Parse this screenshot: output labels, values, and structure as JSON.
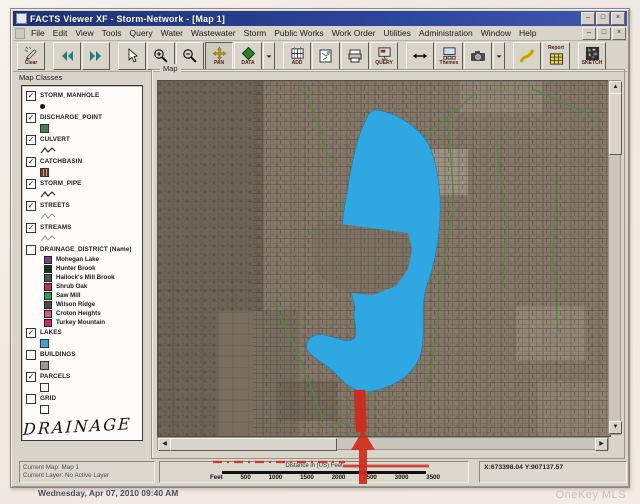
{
  "window": {
    "title": "FACTS Viewer XF - Storm-Network - [Map 1]",
    "controls": [
      "–",
      "□",
      "×"
    ],
    "menu_items": [
      "File",
      "Edit",
      "View",
      "Tools",
      "Query",
      "Water",
      "Wastewater",
      "Storm",
      "Public Works",
      "Work Order",
      "Utilities",
      "Administration",
      "Window",
      "Help"
    ]
  },
  "toolbar": {
    "groups": [
      [
        {
          "name": "clear-button",
          "icon": "pencil",
          "label": "Clear"
        }
      ],
      [
        {
          "name": "previous-view-button",
          "icon": "arrows-left",
          "label": ""
        },
        {
          "name": "next-view-button",
          "icon": "arrows-right",
          "label": ""
        }
      ],
      [
        {
          "name": "pointer-button",
          "icon": "pointer",
          "label": ""
        },
        {
          "name": "zoom-in-button",
          "icon": "zoom-in",
          "label": ""
        },
        {
          "name": "zoom-out-button",
          "icon": "zoom-out",
          "label": ""
        },
        {
          "name": "pan-button",
          "icon": "pan",
          "label": "PAN",
          "pressed": true
        },
        {
          "name": "data-button",
          "icon": "data",
          "label": "DATA"
        },
        {
          "name": "data-dropdown",
          "icon": "caret",
          "label": "",
          "sliver": true
        }
      ],
      [
        {
          "name": "add-button",
          "icon": "grid",
          "label": "ADD"
        },
        {
          "name": "map-sheet-button",
          "icon": "map-sheet",
          "label": ""
        },
        {
          "name": "print-button",
          "icon": "printer",
          "label": ""
        },
        {
          "name": "query-button",
          "icon": "query",
          "label": "QUERY"
        }
      ],
      [
        {
          "name": "measure-button",
          "icon": "measure",
          "label": ""
        },
        {
          "name": "themes-button",
          "icon": "themes",
          "label": "Themes"
        },
        {
          "name": "camera-button",
          "icon": "camera",
          "label": ""
        },
        {
          "name": "camera-dropdown",
          "icon": "caret",
          "label": "",
          "sliver": true
        }
      ],
      [
        {
          "name": "report-flow-button",
          "icon": "swoosh",
          "label": ""
        },
        {
          "name": "report-button",
          "icon": "report-table",
          "label": "Report",
          "label_top": true
        }
      ],
      [
        {
          "name": "sketch-button",
          "icon": "sketch",
          "label": "SKETCH"
        }
      ]
    ]
  },
  "map_classes": {
    "title": "Map Classes",
    "items": [
      {
        "label": "STORM_MANHOLE",
        "checked": true,
        "symbol": "dot"
      },
      {
        "label": "DISCHARGE_POINT",
        "checked": true,
        "symbol": "green-square"
      },
      {
        "label": "CULVERT",
        "checked": true,
        "symbol": "zigzag"
      },
      {
        "label": "CATCHBASIN",
        "checked": true,
        "symbol": "striped-square"
      },
      {
        "label": "STORM_PIPE",
        "checked": true,
        "symbol": "zigzag"
      },
      {
        "label": "STREETS",
        "checked": true,
        "symbol": "zigzag-light"
      },
      {
        "label": "STREAMS",
        "checked": true,
        "symbol": "zigzag-light"
      },
      {
        "label": "DRAINAGE_DISTRICT (Name)",
        "checked": false,
        "symbol": "none",
        "children": [
          {
            "label": "Mohegan Lake",
            "color": "#7c3f7e"
          },
          {
            "label": "Hunter Brook",
            "color": "#20301f"
          },
          {
            "label": "Hallock's Mill Brook",
            "color": "#4c5a4a"
          },
          {
            "label": "Shrub Oak",
            "color": "#c22a58"
          },
          {
            "label": "Saw Mill",
            "color": "#2f9e50"
          },
          {
            "label": "Wilson Ridge",
            "color": "#4a4a4a"
          },
          {
            "label": "Croton Heights",
            "color": "#e0557d"
          },
          {
            "label": "Turkey Mountain",
            "color": "#cc2a66"
          }
        ]
      },
      {
        "label": "LAKES",
        "checked": true,
        "symbol": "blue-square"
      },
      {
        "label": "BUILDINGS",
        "checked": false,
        "symbol": "gray-square"
      },
      {
        "label": "PARCELS",
        "checked": true,
        "symbol": "white-square"
      },
      {
        "label": "GRID",
        "checked": false,
        "symbol": "white-square"
      }
    ],
    "annotation": "DRAINAGE"
  },
  "map": {
    "group_label": "Map",
    "lake_color": "#2ea7e2",
    "annotation_red": "#cf2a1b"
  },
  "status_bar": {
    "current_map_label": "Current Map:",
    "current_map_value": "Map 1",
    "current_layer_label": "Current Layer:",
    "current_layer_value": "No Active Layer",
    "scale": {
      "label": "Distance in (US) Feet",
      "ticks": [
        "Feet",
        "500",
        "1000",
        "1500",
        "2000",
        "2500",
        "3000",
        "3500"
      ]
    },
    "coordinates": "X:673398.04 Y:907137.57"
  },
  "footer": {
    "datetime": "Wednesday, Apr 07, 2010  09:40 AM",
    "watermark": "OneKey MLS"
  }
}
